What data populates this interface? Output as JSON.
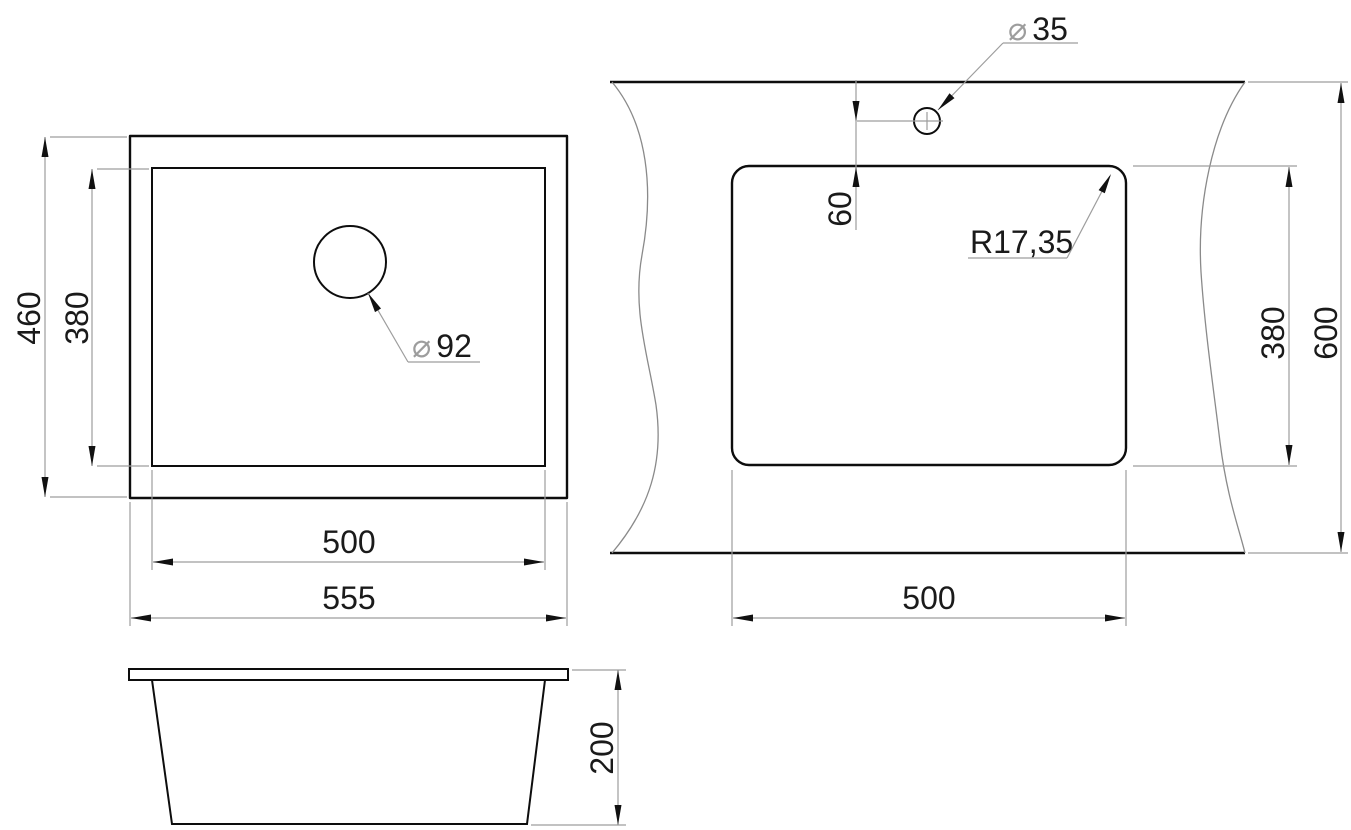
{
  "diagram": {
    "type": "technical-drawing",
    "subject": "kitchen sink installation dimensions (top view, countertop cutout view, side view)",
    "units": "mm",
    "colors": {
      "geometry_line": "#0d0d0d",
      "dimension_line": "#9d9d9d",
      "text": "#1a1a1a",
      "background": "#ffffff"
    },
    "symbols": {
      "diameter": "⌀"
    },
    "top_view": {
      "outer_width": "555",
      "outer_depth": "460",
      "bowl_width": "500",
      "bowl_depth": "380",
      "drain_diameter": "92"
    },
    "cutout_view": {
      "cutout_width": "500",
      "cutout_depth": "380",
      "counter_depth": "600",
      "faucet_hole_diameter": "35",
      "faucet_offset": "60",
      "corner_radius": "R17,35"
    },
    "side_view": {
      "height": "200"
    }
  }
}
